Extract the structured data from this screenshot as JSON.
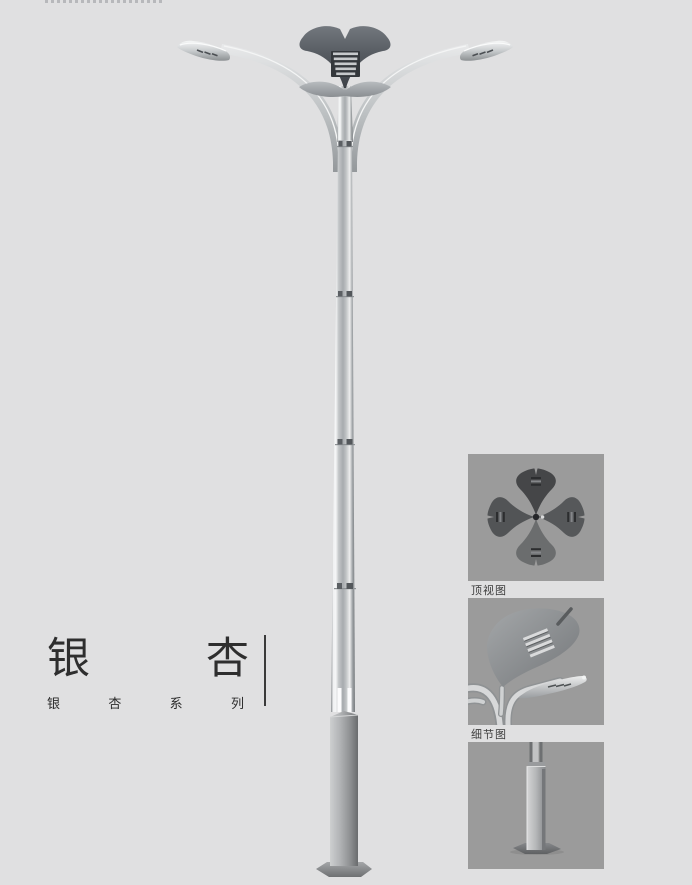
{
  "title_block": {
    "char_1": "银",
    "char_2": "杏",
    "sub_char_1": "银",
    "sub_char_2": "杏",
    "sub_char_3": "系",
    "sub_char_4": "列"
  },
  "detail_panels": {
    "top_view": {
      "caption": "顶视图"
    },
    "detail_view": {
      "caption": "细节图"
    },
    "base_view": {
      "caption": ""
    }
  },
  "colors": {
    "page_bg": "#e0e0e1",
    "panel_bg": "#9b9b9b",
    "title_text": "#2e2e2e",
    "caption_text": "#3c3c3c",
    "metal_light": "#f2f3f3",
    "metal_mid": "#b3b7ba",
    "metal_dark": "#6f7376",
    "crown_dark": "#464b51",
    "rule": "#3a3a3a"
  }
}
